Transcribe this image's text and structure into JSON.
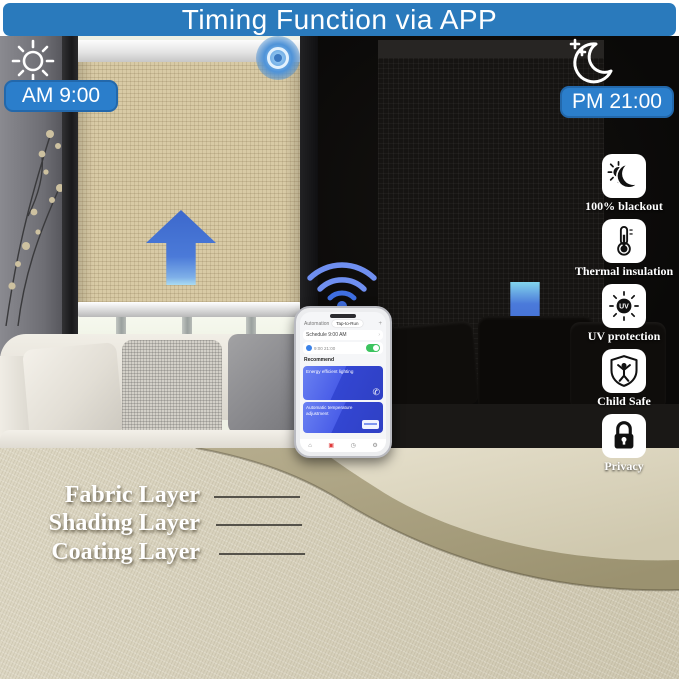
{
  "banner": {
    "title": "Timing Function via APP"
  },
  "schedule": {
    "day": {
      "icon": "sun-icon",
      "time": "AM 9:00"
    },
    "night": {
      "icon": "moon-icon",
      "time": "PM 21:00"
    }
  },
  "features": [
    {
      "icon": "blackout-icon",
      "label": "100% blackout"
    },
    {
      "icon": "thermal-icon",
      "label": "Thermal insulation"
    },
    {
      "icon": "uv-icon",
      "label": "UV protection",
      "icon_text": "UV"
    },
    {
      "icon": "child-safe-icon",
      "label": "Child Safe"
    },
    {
      "icon": "privacy-icon",
      "label": "Privacy"
    }
  ],
  "phone": {
    "header": "Automation",
    "header_tab": "Tap-to-Run",
    "add_button": "+",
    "schedule_row": "Schedule 9:00 AM",
    "times_row": "9:00  21:00",
    "recommend": "Recommend",
    "cards": [
      {
        "title": "Energy efficient lighting"
      },
      {
        "title": "Automatic temperature adjustment"
      }
    ]
  },
  "layers": [
    "Fabric Layer",
    "Shading Layer",
    "Coating Layer"
  ],
  "colors": {
    "banner_blue": "#2a7abc",
    "badge_blue": "#2b7ecb",
    "arrow_blue": "#3f6fd8",
    "toggle_green": "#3cc45f",
    "card_blue": "#3d55dd",
    "blind_beige": "#d8caa5",
    "night_black": "#0b0a08"
  }
}
